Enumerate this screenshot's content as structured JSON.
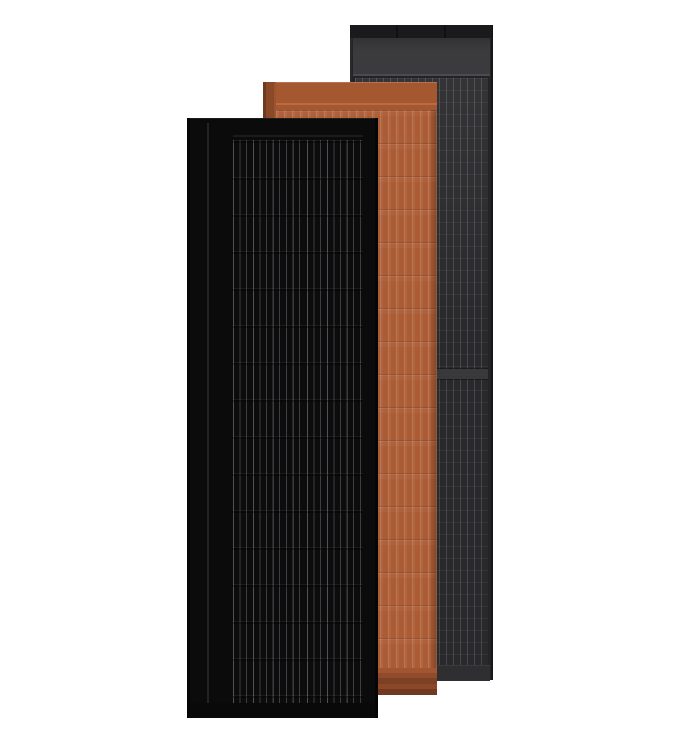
{
  "scene": {
    "title": "Three overlapping tall solar roof panels on a white background",
    "background": "#ffffff",
    "panels": [
      {
        "name": "dark-gray-panel",
        "position": "back",
        "style": "Dark gray framed solar panel with top header band, fine vertical cell stripes and a horizontal module divider",
        "frame_color": "#242426",
        "header_color": "#3b3b3d",
        "cell_color": "#29292b",
        "stripe_color": "#48484c"
      },
      {
        "name": "terracotta-panel",
        "position": "middle",
        "style": "Terracotta colored solar shingle with vertical ribs, horizontal course lines, dark left edge and layered bottom lip",
        "face_color": "#ac5c35",
        "edge_color": "#8a4a28",
        "bottom_color": "#713a20"
      },
      {
        "name": "black-panel",
        "position": "front",
        "style": "All-black solar panel with two columns of thin vertical busbar stripes and faint horizontal cell rows",
        "face_color": "#0b0b0c",
        "stripe_color": "#3e3e42"
      }
    ]
  },
  "colors": {
    "bg": "#ffffff",
    "gray_frame": "#242426",
    "gray_top_cap": "#1a1a1c",
    "gray_header": "#3b3b3d",
    "gray_header_line": "#4b4b4f",
    "gray_cell_bg": "#29292b",
    "gray_stripe": "#48484c",
    "gray_divider": "#39393c",
    "gray_bottom": "#2f2f31",
    "terra_face": "#ac5c35",
    "terra_top_band": "#a5572f",
    "terra_seam": "#b96c41",
    "terra_edge_dark": "#6e3a20",
    "terra_edge": "#8a4a28",
    "terra_bottom_mid": "#8a4828",
    "terra_bottom_dark": "#713a20",
    "black_face": "#0b0b0c",
    "black_frame": "#050506",
    "black_stripe": "#3e3e42",
    "black_flange_line": "#232325",
    "black_bottom": "#090909"
  }
}
